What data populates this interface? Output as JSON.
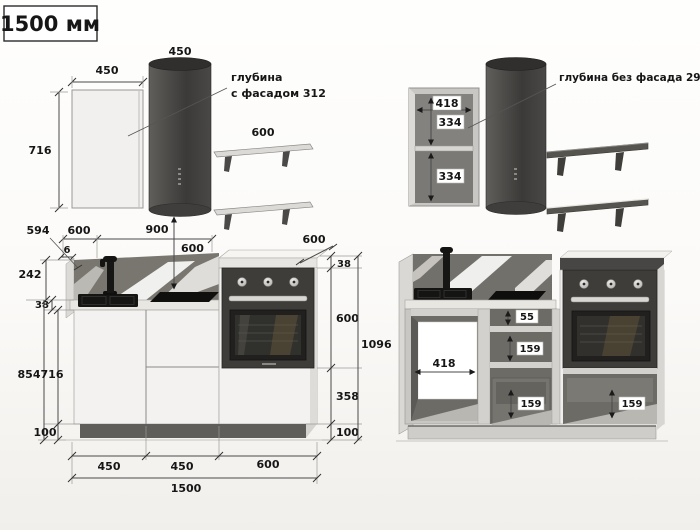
{
  "header": {
    "title": "1500 мм"
  },
  "wall_view_left": {
    "cabinet_width": "450",
    "hood_width": "450",
    "cabinet_height": "716",
    "shelf_width": "600",
    "note_line1": "глубина",
    "note_line2": "с фасадом 312"
  },
  "wall_view_right": {
    "inner_width": "418",
    "upper_section": "334",
    "lower_section": "334",
    "note": "глубина без фасада 296"
  },
  "front_view_left": {
    "top": {
      "d594": "594",
      "d600": "600",
      "d6": "6",
      "d900": "900",
      "hood_gap": "600",
      "depth": "600"
    },
    "left": {
      "backsplash": "242",
      "worktop": "38",
      "base_total": "854",
      "carcass": "716",
      "plinth": "100"
    },
    "right": {
      "top_panel": "38",
      "oven": "600",
      "under_oven": "358",
      "plinth": "100",
      "total": "1096"
    },
    "bottom": {
      "section1": "450",
      "section2": "450",
      "section3": "600",
      "total": "1500"
    }
  },
  "front_view_right": {
    "opening_width": "418",
    "top_gap": "55",
    "mid_drawer": "159",
    "bottom_drawer_mid": "159",
    "bottom_drawer_right": "159"
  },
  "colors": {
    "hood_dark": "#3b3a38",
    "oven_front": "#3e3d3a",
    "backsplash": "#78766f",
    "cabinet_front": "#f3f2f0",
    "plinth_dark": "#5f5e5b",
    "dim_text": "#161616"
  }
}
